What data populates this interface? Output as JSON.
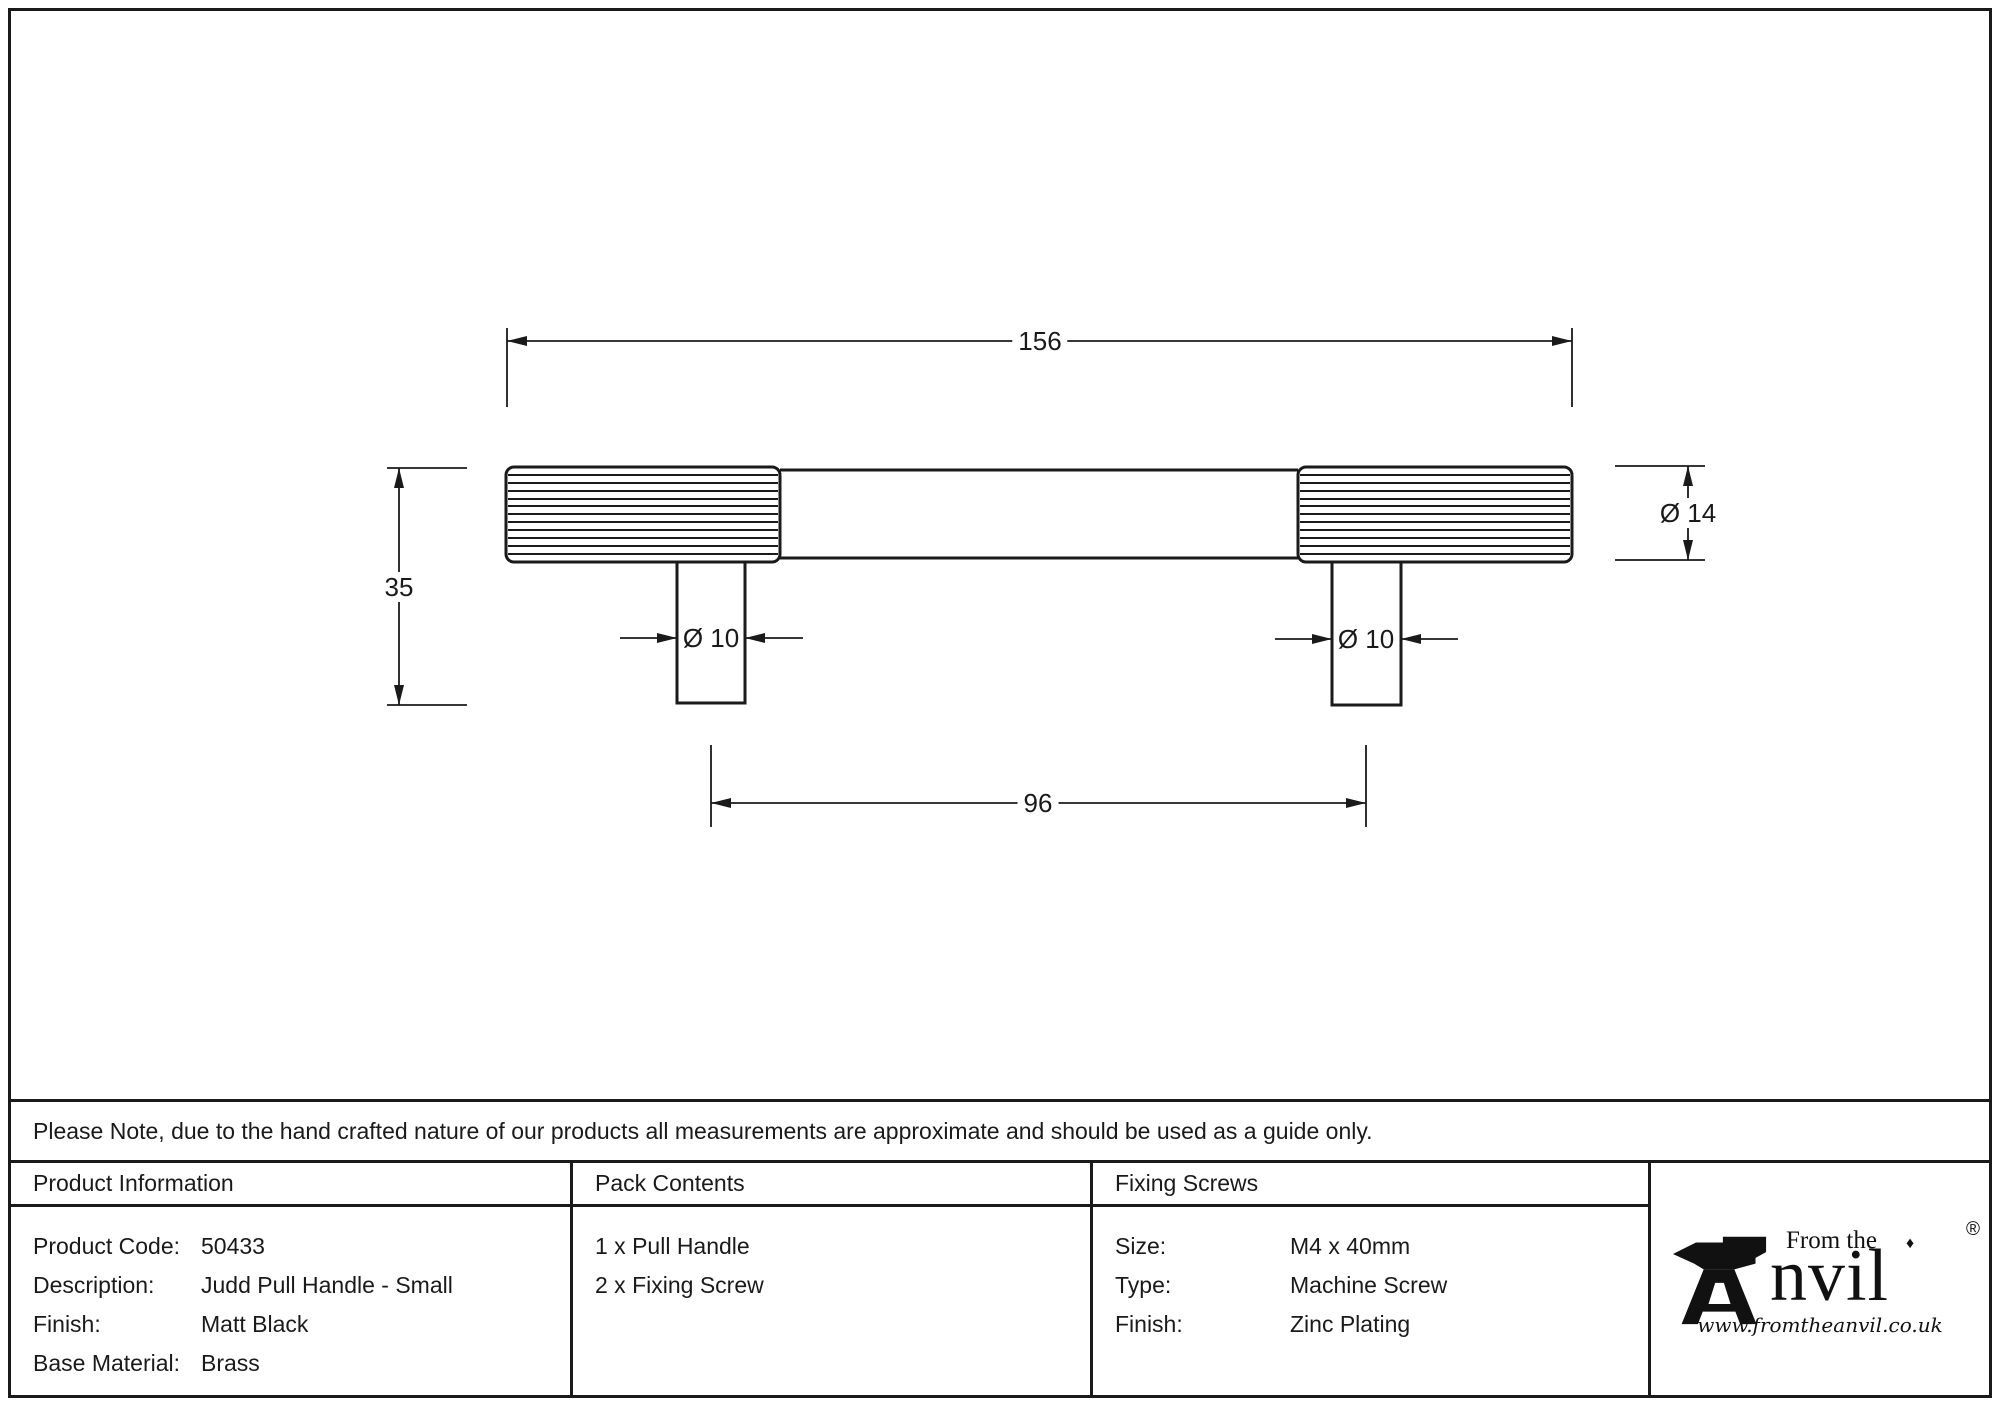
{
  "drawing": {
    "dim_overall_length": "156",
    "dim_height": "35",
    "dim_post_diameter_left": "Ø 10",
    "dim_post_diameter_right": "Ø 10",
    "dim_bar_diameter": "Ø 14",
    "dim_fixing_centres": "96"
  },
  "note": "Please Note, due to the hand crafted nature of our products all measurements are approximate and should be used as a guide only.",
  "table": {
    "product_information": {
      "header": "Product Information",
      "rows": [
        {
          "label": "Product Code:",
          "value": "50433"
        },
        {
          "label": "Description:",
          "value": "Judd Pull Handle - Small"
        },
        {
          "label": "Finish:",
          "value": "Matt Black"
        },
        {
          "label": "Base Material:",
          "value": "Brass"
        }
      ]
    },
    "pack_contents": {
      "header": "Pack Contents",
      "items": [
        "1 x Pull Handle",
        "2 x Fixing Screw"
      ]
    },
    "fixing_screws": {
      "header": "Fixing Screws",
      "rows": [
        {
          "label": "Size:",
          "value": "M4 x 40mm"
        },
        {
          "label": "Type:",
          "value": "Machine Screw"
        },
        {
          "label": "Finish:",
          "value": "Zinc Plating"
        }
      ]
    }
  },
  "logo": {
    "tagline": "From the",
    "brand": "Anvil",
    "brand_suffix": "nvil",
    "registered": "®",
    "diamond": "♦",
    "website": "www.fromtheanvil.co.uk"
  },
  "colors": {
    "line": "#1a1a1a",
    "background": "#ffffff"
  }
}
